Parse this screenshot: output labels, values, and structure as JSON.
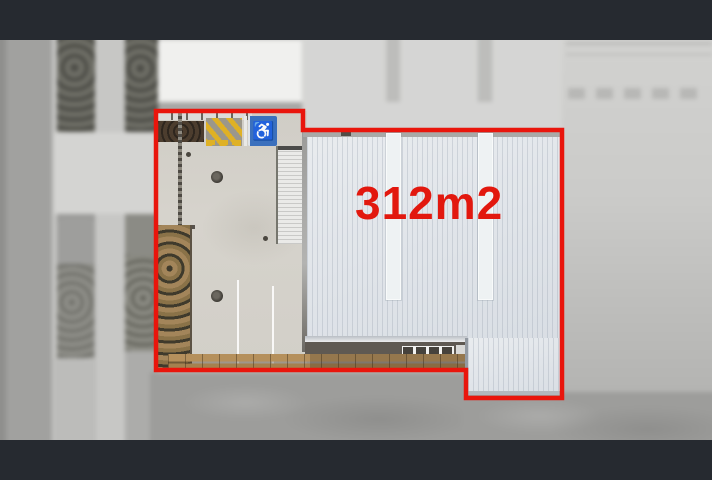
{
  "frame": {
    "bar_color": "#262a30"
  },
  "photo": {
    "kind": "aerial-photograph-industrial-unit",
    "area_label": {
      "text": "312m2",
      "color": "#e2180e"
    },
    "boundary": {
      "color": "#e9150c",
      "stroke_width": 4.5,
      "points": "156,71 303,71 303,90 562,90 562,358 466,358 466,330 156,330"
    },
    "markings": {
      "disabled_parking_icon": "♿",
      "disabled_sign_color": "#3b70bd",
      "loading_hatch_color": "#dfb125"
    },
    "surfaces": {
      "warehouse_roof": "#e0e4e9",
      "yard_concrete": "#d6d3cc",
      "timber_deck": "#ad8a58",
      "road": "#9d9d9b"
    }
  }
}
